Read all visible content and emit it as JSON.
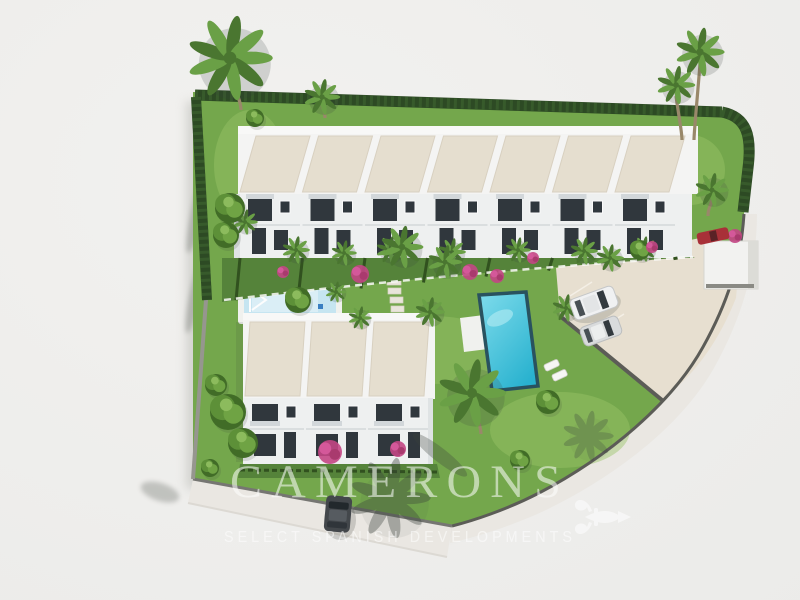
{
  "watermark": {
    "brand": "CAMERONS",
    "tagline": "SELECT SPANISH DEVELOPMENTS",
    "ornament": "fleur-de-lis-icon",
    "color": "#ffffff",
    "opacity": 0.55
  },
  "scene": {
    "type": "aerial-3d-architectural-render",
    "upper_row_units": 7,
    "lower_row_units": 3,
    "pools": 2,
    "cars_visible": 4
  },
  "palette": {
    "bg": "#f0efed",
    "lawn": "#74a74c",
    "lawn_light": "#9ac468",
    "lawn_dark": "#55833a",
    "hedge": "#2d4a24",
    "hedge_light": "#3e6530",
    "roof": "#e5decf",
    "roof_edge": "#d8d0c0",
    "white_wall": "#f4f4f3",
    "facade": "#eef0f0",
    "facade_shade": "#dfe3e4",
    "window": "#30373d",
    "awning": "#d2d7da",
    "road": "#eae7e2",
    "parking": "#e7dfd0",
    "wall_dark": "#5c5c57",
    "wall_light": "#96968f",
    "pool_light": "#7fdcec",
    "pool_deep": "#29b2cf",
    "pool_rim": "#29525f",
    "kids_pool": "#c6e5f1",
    "deck": "#f0f1ee",
    "flower": "#c34684",
    "palm_leaf": "#6aa046",
    "palm_leaf_dark": "#4a7630",
    "leafy": "#5d9038",
    "leafy_dark": "#416c27",
    "trunk": "#99886a",
    "car_white": "#f0f1f2",
    "car_silver": "#d9dbdc",
    "car_red": "#a83038",
    "car_dark": "#43474b",
    "shadow": "#3a423c",
    "wm": "#ffffff"
  }
}
